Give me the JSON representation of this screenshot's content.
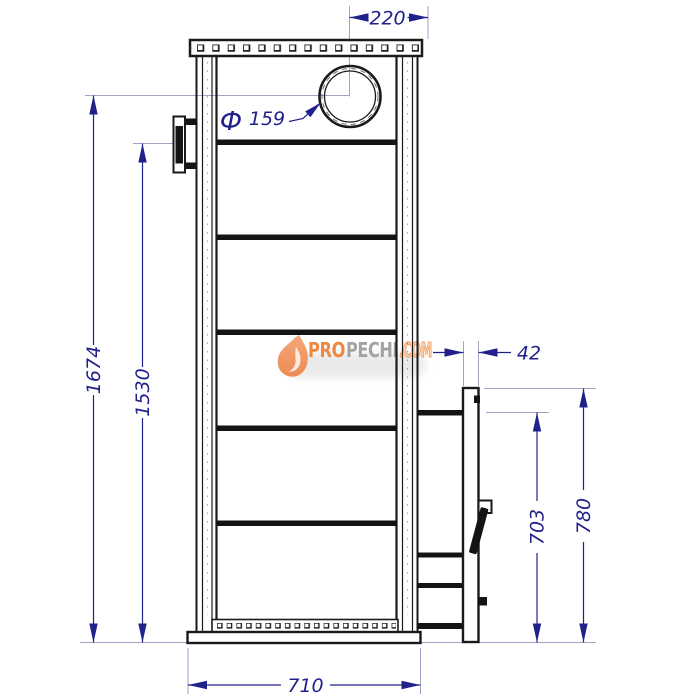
{
  "drawing": {
    "type": "technical-drawing",
    "subject": "Wood-burning stove side view with chimney outlet, internal baffles and firebox door tunnel",
    "units": "mm"
  },
  "dimensions": {
    "chimney_offset_width": "220",
    "chimney_diameter_symbol": "Ф",
    "chimney_diameter": "159",
    "overall_height": "1674",
    "bracket_height": "1530",
    "door_panel_thickness": "42",
    "tunnel_top_height": "703",
    "door_top_height": "780",
    "base_width": "710"
  },
  "watermark": {
    "part_orange": "PRO",
    "part_gray": "PECHI",
    "part_suffix": ".COM"
  },
  "colors": {
    "line": "#1a1a1a",
    "dimension": "#21218c",
    "extension": "#9fa3c4",
    "watermark_orange": "#ee8741",
    "watermark_gray": "#a3a3a3",
    "background": "#ffffff"
  }
}
